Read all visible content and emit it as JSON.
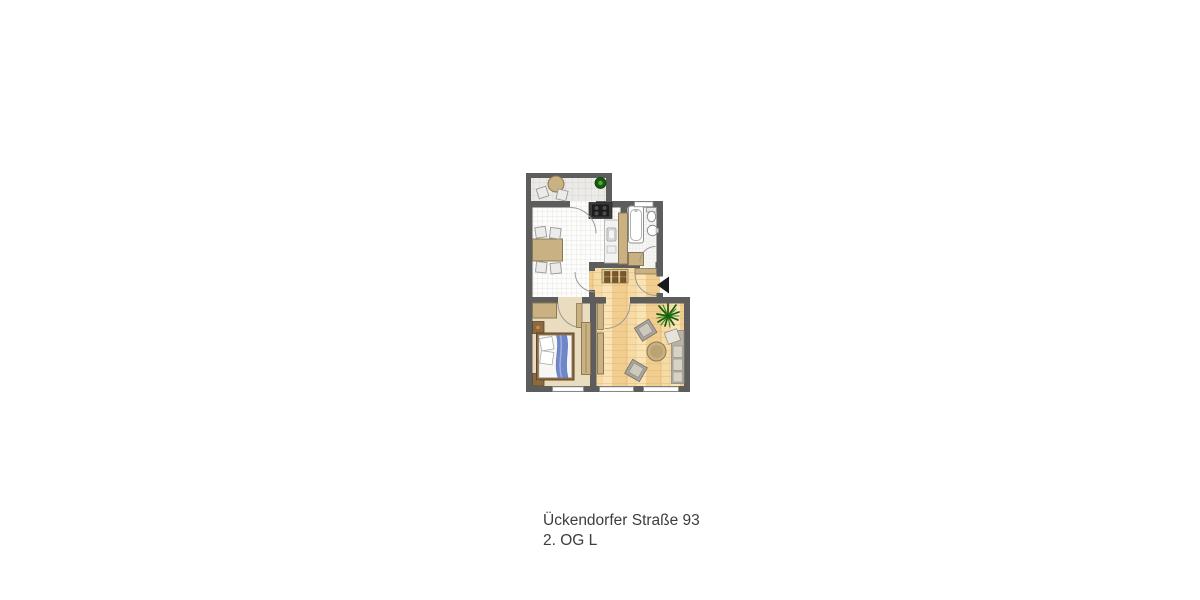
{
  "caption": {
    "address": "Ückendorfer Straße 93",
    "floor": "2. OG L"
  },
  "icons": {
    "entrance_marker": "entrance-arrow-icon",
    "balcony_plant": "potted-plant-icon",
    "living_plant": "palm-plant-icon"
  },
  "colors": {
    "background": "#ffffff",
    "text": "#3d3d3d",
    "wall": "#5d5d5d",
    "wood-light": "#f7dba4",
    "wood-mid": "#f1cd90",
    "wood-line": "#dcae6e",
    "tile-balcony": "#eceae6",
    "tile-kitchen": "#fdfdfc",
    "tile-bath": "#f6f6f4",
    "tile-line": "#d4d2ce",
    "bedroom-floor": "#eadcbe",
    "tan": "#c9b183",
    "tan-dark": "#8a7a52",
    "brown": "#8a6a42",
    "brown-dark": "#5f4727",
    "chair": "#ebebe9",
    "chair-line": "#9a9a98",
    "bed-blue": "#6f86c8",
    "sofa": "#b9b3a3",
    "sofa-light": "#d6d2c6",
    "gray-chair": "#a8a49a",
    "plant": "#2c8a1e",
    "plant-dark": "#155c0c",
    "fix-line": "#8f8f8f",
    "counter": "#f2f2f0",
    "stove": "#1c1c1c",
    "arrow": "#1a1a1a"
  }
}
